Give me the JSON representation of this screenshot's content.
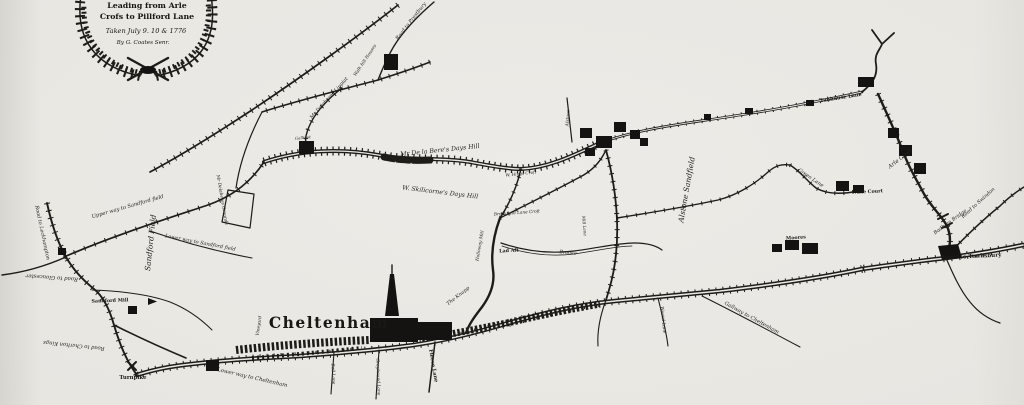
{
  "map": {
    "title_semantic": "Historic 1776 road survey map of Cheltenham",
    "colors": {
      "paper": "#e9e7e2",
      "ink": "#1d1c19"
    },
    "cartouche": {
      "lines": [
        "Leading from Arle",
        "Crofs to Pillford Lane",
        "Taken July 9. 10 & 1776",
        "By G. Coates Senr."
      ]
    },
    "town": {
      "name": "Cheltenham"
    },
    "labels": [
      {
        "text": "Mr De la Bere's Days Hill",
        "x": 440,
        "y": 152,
        "rot": -6,
        "size": 6.2
      },
      {
        "text": "Lears Lane",
        "x": 408,
        "y": 166,
        "rot": 4,
        "size": 4.6,
        "cls": "onroad"
      },
      {
        "text": "W. Skilicorne's Days Hill",
        "x": 440,
        "y": 194,
        "rot": 7,
        "size": 6.2
      },
      {
        "text": "Mr Delaberes Lippiat",
        "x": 330,
        "y": 99,
        "rot": -48,
        "size": 5
      },
      {
        "text": "Mr Delaberes Grounds",
        "x": 221,
        "y": 200,
        "rot": 80,
        "size": 4.4
      },
      {
        "text": "Road to Prestbury",
        "x": 412,
        "y": 22,
        "rot": -52,
        "size": 5
      },
      {
        "text": "Walk hill Houses",
        "x": 366,
        "y": 61,
        "rot": -56,
        "size": 4.4
      },
      {
        "text": "Gallipot",
        "x": 303,
        "y": 139,
        "rot": -6,
        "size": 4
      },
      {
        "text": "Upper way to Sandford field",
        "x": 128,
        "y": 208,
        "rot": -16,
        "size": 5.2
      },
      {
        "text": "Sandford Field",
        "x": 153,
        "y": 243,
        "rot": -84,
        "size": 7.5
      },
      {
        "text": "Lower way to Sandford field",
        "x": 200,
        "y": 244,
        "rot": 11,
        "size": 5
      },
      {
        "text": "Road to Leckhampton",
        "x": 41,
        "y": 233,
        "rot": 78,
        "size": 5
      },
      {
        "text": "Road to Gloucester",
        "x": 52,
        "y": 276,
        "rot": 184,
        "size": 5.4
      },
      {
        "text": "Sandford Mill",
        "x": 110,
        "y": 302,
        "rot": -2,
        "size": 4.8,
        "cls": "print"
      },
      {
        "text": "Road to Charlton Kings",
        "x": 74,
        "y": 344,
        "rot": 186,
        "size": 5.2
      },
      {
        "text": "Turnpike",
        "x": 133,
        "y": 379,
        "rot": 0,
        "size": 5.4,
        "cls": "print"
      },
      {
        "text": "Lower way to Cheltenham",
        "x": 252,
        "y": 379,
        "rot": 13,
        "size": 5.4
      },
      {
        "text": "Vineyard",
        "x": 260,
        "y": 326,
        "rot": -82,
        "size": 4.4
      },
      {
        "text": "Bell Lane",
        "x": 332,
        "y": 374,
        "rot": 87,
        "size": 4.4
      },
      {
        "text": "Greyhound Lane",
        "x": 377,
        "y": 377,
        "rot": 88,
        "size": 4.4
      },
      {
        "text": "Fleece Lane",
        "x": 432,
        "y": 366,
        "rot": 80,
        "size": 5,
        "cls": "print"
      },
      {
        "text": "The Knapp",
        "x": 459,
        "y": 297,
        "rot": -38,
        "size": 5
      },
      {
        "text": "Holloway Mill",
        "x": 481,
        "y": 246,
        "rot": -80,
        "size": 4.4
      },
      {
        "text": "Lad Aft",
        "x": 509,
        "y": 252,
        "rot": -3,
        "size": 4.8,
        "cls": "print"
      },
      {
        "text": "Brookfield Lane Croft",
        "x": 517,
        "y": 214,
        "rot": -4,
        "size": 4.2
      },
      {
        "text": "W. Higgs Croft",
        "x": 521,
        "y": 175,
        "rot": -6,
        "size": 4.2
      },
      {
        "text": "Brooke",
        "x": 568,
        "y": 254,
        "rot": 6,
        "size": 4.8
      },
      {
        "text": "Mill Lane",
        "x": 583,
        "y": 226,
        "rot": 85,
        "size": 4.2
      },
      {
        "text": "Alstone",
        "x": 569,
        "y": 118,
        "rot": -86,
        "size": 4.4
      },
      {
        "text": "Alstone Sandfield",
        "x": 689,
        "y": 190,
        "rot": -80,
        "size": 7.5
      },
      {
        "text": "Westal Lane",
        "x": 662,
        "y": 320,
        "rot": 84,
        "size": 4.4
      },
      {
        "text": "Gallway to Cheltenham",
        "x": 751,
        "y": 319,
        "rot": 29,
        "size": 5.2
      },
      {
        "text": "Tanhouse Lane",
        "x": 841,
        "y": 99,
        "rot": -9,
        "size": 5,
        "cls": "print"
      },
      {
        "text": "Green Lane",
        "x": 810,
        "y": 179,
        "rot": 34,
        "size": 5
      },
      {
        "text": "Arle Croft",
        "x": 901,
        "y": 160,
        "rot": -38,
        "size": 5.6
      },
      {
        "text": "Arle Court",
        "x": 869,
        "y": 193,
        "rot": -3,
        "size": 4.8,
        "cls": "print"
      },
      {
        "text": "Moores",
        "x": 796,
        "y": 239,
        "rot": -4,
        "size": 4.8,
        "cls": "print"
      },
      {
        "text": "Badham Bridge",
        "x": 951,
        "y": 223,
        "rot": -36,
        "size": 5
      },
      {
        "text": "Road to Swindon",
        "x": 979,
        "y": 204,
        "rot": -42,
        "size": 5
      },
      {
        "text": "Road to Tewksbury",
        "x": 972,
        "y": 258,
        "rot": -3,
        "size": 5.6,
        "cls": "print"
      }
    ]
  }
}
